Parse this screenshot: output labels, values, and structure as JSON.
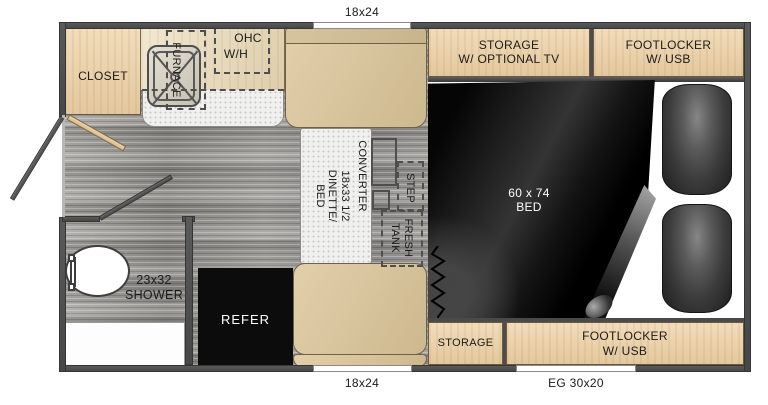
{
  "plan": {
    "title": "truck camper floor plan",
    "windows": {
      "top": "18x24",
      "bottom_left": "18x24",
      "bottom_right": "EG 30x20"
    },
    "labels": {
      "closet": "CLOSET",
      "furnace": "FURNACE",
      "ohc": "OHC",
      "wh": "W/H",
      "storage_tv": "STORAGE\nW/ OPTIONAL TV",
      "footlocker_top": "FOOTLOCKER\nW/ USB",
      "converter": "CONVERTER",
      "dinette": "18x33 1/2\nDINETTE/\nBED",
      "step": "STEP",
      "fresh_tank": "FRESH\nTANK",
      "bed": "60 x 74\nBED",
      "shower": "23x32\nSHOWER",
      "refer": "REFER",
      "storage_bottom": "STORAGE",
      "footlocker_bottom": "FOOTLOCKER\nW/ USB"
    },
    "colors": {
      "wall": "#4d4d4d",
      "cabinet_tan": "#ecd3ae",
      "counter_tan": "#e9dcc2",
      "seat_tan": "#d8c59e",
      "floor_gray": "#9f9d99",
      "bed_black": "#0a0a0a",
      "refer_black": "#0c0c0c",
      "window_white": "#ffffff"
    }
  }
}
